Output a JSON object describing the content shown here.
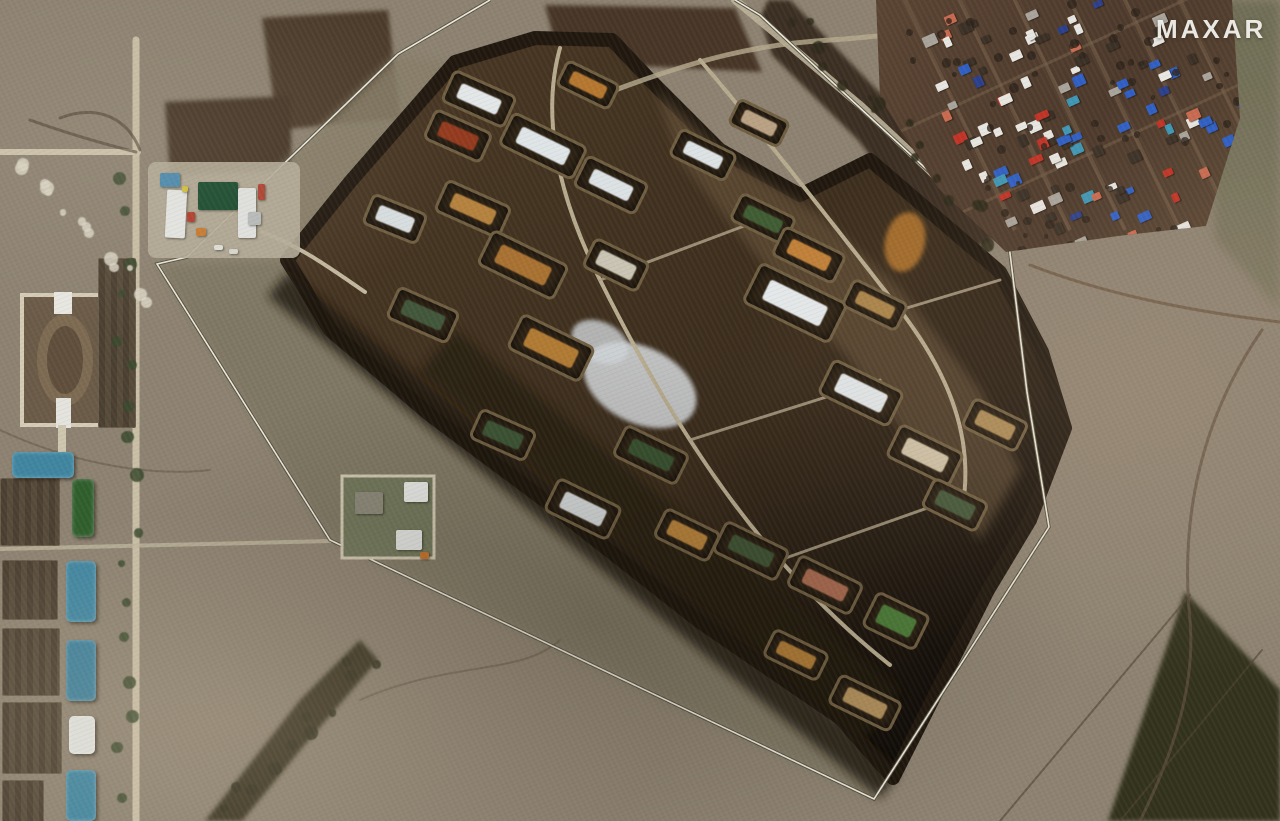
{
  "watermark": {
    "text": "MAXAR"
  },
  "palette": {
    "field": "#8d8271",
    "field_light": "#ac9f87",
    "field_green": "#7c765f",
    "buffer_green": "#7d7662",
    "compound_dark": "#3a2c1c",
    "compound_edge": "#20180f",
    "berm": "#6f5e41",
    "cell_floor": "#2e2315",
    "road_light": "#c9bfa6",
    "track_dark": "#5d4c3a",
    "fence_white": "#ece8dc",
    "debris_white": "#d6dadd",
    "village_ground": "#52402f",
    "teal_roof": "#3f85a0",
    "green_roof": "#2f5e2c"
  },
  "compound": {
    "revetments": [
      {
        "x": 476,
        "y": 96,
        "w": 64,
        "h": 30,
        "rot": 24,
        "content": "white-sheds",
        "color": "#e3e7e8"
      },
      {
        "x": 455,
        "y": 133,
        "w": 58,
        "h": 28,
        "rot": 24,
        "content": "red-scrap-pile",
        "color": "#93391d"
      },
      {
        "x": 540,
        "y": 143,
        "w": 78,
        "h": 32,
        "rot": 26,
        "content": "white-warehouse",
        "color": "#dfe5e7"
      },
      {
        "x": 470,
        "y": 206,
        "w": 66,
        "h": 30,
        "rot": 24,
        "content": "ochre-piles",
        "color": "#b5823e"
      },
      {
        "x": 608,
        "y": 182,
        "w": 64,
        "h": 30,
        "rot": 26,
        "content": "white-sheds",
        "color": "#dce2e4"
      },
      {
        "x": 392,
        "y": 216,
        "w": 54,
        "h": 28,
        "rot": 22,
        "content": "white-shed",
        "color": "#d8dee0"
      },
      {
        "x": 520,
        "y": 262,
        "w": 80,
        "h": 34,
        "rot": 26,
        "content": "tan-piles",
        "color": "#a87131"
      },
      {
        "x": 613,
        "y": 262,
        "w": 56,
        "h": 28,
        "rot": 26,
        "content": "mixed-debris",
        "color": "#c9c4b4"
      },
      {
        "x": 792,
        "y": 300,
        "w": 92,
        "h": 40,
        "rot": 26,
        "content": "white-warehouse",
        "color": "#e4e8ea"
      },
      {
        "x": 420,
        "y": 312,
        "w": 62,
        "h": 30,
        "rot": 24,
        "content": "green-hut",
        "color": "#41563a"
      },
      {
        "x": 548,
        "y": 345,
        "w": 76,
        "h": 34,
        "rot": 26,
        "content": "ochre-piles",
        "color": "#b07a33"
      },
      {
        "x": 760,
        "y": 216,
        "w": 56,
        "h": 26,
        "rot": 26,
        "content": "green-trees",
        "color": "#3f5c33"
      },
      {
        "x": 806,
        "y": 252,
        "w": 64,
        "h": 28,
        "rot": 26,
        "content": "orange-piles",
        "color": "#c08038"
      },
      {
        "x": 858,
        "y": 390,
        "w": 74,
        "h": 34,
        "rot": 26,
        "content": "white-sheds",
        "color": "#e0e5e7"
      },
      {
        "x": 922,
        "y": 452,
        "w": 66,
        "h": 32,
        "rot": 26,
        "content": "mixed-material",
        "color": "#cfc3a8"
      },
      {
        "x": 500,
        "y": 432,
        "w": 56,
        "h": 28,
        "rot": 24,
        "content": "green-hut",
        "color": "#3c5434"
      },
      {
        "x": 580,
        "y": 506,
        "w": 66,
        "h": 32,
        "rot": 26,
        "content": "white-debris",
        "color": "#d3d7d8"
      },
      {
        "x": 648,
        "y": 452,
        "w": 66,
        "h": 30,
        "rot": 26,
        "content": "green-sheds",
        "color": "#37502f"
      },
      {
        "x": 684,
        "y": 532,
        "w": 56,
        "h": 28,
        "rot": 26,
        "content": "ochre-pile",
        "color": "#b5813a"
      },
      {
        "x": 748,
        "y": 548,
        "w": 66,
        "h": 30,
        "rot": 26,
        "content": "green-trucks",
        "color": "#3e5233"
      },
      {
        "x": 822,
        "y": 582,
        "w": 66,
        "h": 30,
        "rot": 26,
        "content": "red-white-material",
        "color": "#a86a50"
      },
      {
        "x": 893,
        "y": 618,
        "w": 54,
        "h": 34,
        "rot": 26,
        "content": "green-roof-building",
        "color": "#4c7c39"
      },
      {
        "x": 793,
        "y": 652,
        "w": 56,
        "h": 26,
        "rot": 26,
        "content": "ochre-pile",
        "color": "#ad7a36"
      },
      {
        "x": 862,
        "y": 700,
        "w": 64,
        "h": 28,
        "rot": 26,
        "content": "tan-piles",
        "color": "#b08f5c"
      },
      {
        "x": 952,
        "y": 502,
        "w": 56,
        "h": 28,
        "rot": 26,
        "content": "green-vehicles",
        "color": "#44583a"
      },
      {
        "x": 992,
        "y": 422,
        "w": 56,
        "h": 28,
        "rot": 26,
        "content": "tan-piles",
        "color": "#ab8a56"
      },
      {
        "x": 872,
        "y": 302,
        "w": 56,
        "h": 26,
        "rot": 26,
        "content": "tan-piles",
        "color": "#a98349"
      },
      {
        "x": 700,
        "y": 152,
        "w": 58,
        "h": 26,
        "rot": 26,
        "content": "white-sheds",
        "color": "#dde2e4"
      },
      {
        "x": 585,
        "y": 82,
        "w": 54,
        "h": 24,
        "rot": 26,
        "content": "orange-piles",
        "color": "#b5772f"
      },
      {
        "x": 756,
        "y": 120,
        "w": 52,
        "h": 24,
        "rot": 26,
        "content": "mixed-material",
        "color": "#b9a183"
      }
    ]
  },
  "west_facility": {
    "buildings": [
      {
        "x": 12,
        "y": 452,
        "w": 62,
        "h": 26,
        "rot": 0,
        "color": "#3f85a0",
        "name": "teal-roof-warehouse"
      },
      {
        "x": 72,
        "y": 479,
        "w": 22,
        "h": 58,
        "rot": 0,
        "color": "#2f5e2c",
        "name": "green-roof-warehouse"
      },
      {
        "x": 66,
        "y": 561,
        "w": 30,
        "h": 61,
        "rot": 0,
        "color": "#3f85a0",
        "name": "teal-roof-warehouse"
      },
      {
        "x": 66,
        "y": 640,
        "w": 30,
        "h": 61,
        "rot": 0,
        "color": "#3d7f9a",
        "name": "teal-roof-warehouse"
      },
      {
        "x": 69,
        "y": 716,
        "w": 26,
        "h": 38,
        "rot": 0,
        "color": "#dfe2df",
        "name": "white-roof-warehouse"
      },
      {
        "x": 66,
        "y": 770,
        "w": 30,
        "h": 51,
        "rot": 0,
        "color": "#3f85a0",
        "name": "teal-roof-warehouse"
      }
    ],
    "garden_plots": [
      {
        "x": 2,
        "y": 560,
        "w": 54,
        "h": 58
      },
      {
        "x": 2,
        "y": 628,
        "w": 56,
        "h": 66
      },
      {
        "x": 2,
        "y": 702,
        "w": 58,
        "h": 70
      },
      {
        "x": 2,
        "y": 780,
        "w": 40,
        "h": 41
      },
      {
        "x": 0,
        "y": 478,
        "w": 58,
        "h": 66
      },
      {
        "x": 98,
        "y": 258,
        "w": 36,
        "h": 168
      }
    ]
  },
  "north_facility": {
    "items": [
      {
        "x": 160,
        "y": 173,
        "w": 20,
        "h": 14,
        "rot": 0,
        "color": "#4a8ab0",
        "name": "blue-roof-building"
      },
      {
        "x": 166,
        "y": 190,
        "w": 20,
        "h": 48,
        "rot": 3,
        "color": "#e6e8e6",
        "name": "white-tent-building"
      },
      {
        "x": 198,
        "y": 182,
        "w": 40,
        "h": 28,
        "rot": 0,
        "color": "#174a2e",
        "name": "reservoir-pond"
      },
      {
        "x": 238,
        "y": 188,
        "w": 18,
        "h": 50,
        "rot": 0,
        "color": "#e2e4e2",
        "name": "white-building"
      },
      {
        "x": 187,
        "y": 212,
        "w": 8,
        "h": 10,
        "rot": 0,
        "color": "#b33b2a",
        "name": "red-container"
      },
      {
        "x": 196,
        "y": 228,
        "w": 10,
        "h": 8,
        "rot": 0,
        "color": "#c97a2e",
        "name": "orange-container"
      },
      {
        "x": 182,
        "y": 186,
        "w": 6,
        "h": 6,
        "rot": 0,
        "color": "#d4c23a",
        "name": "yellow-object"
      },
      {
        "x": 258,
        "y": 184,
        "w": 7,
        "h": 16,
        "rot": 0,
        "color": "#b04030",
        "name": "red-tower"
      },
      {
        "x": 248,
        "y": 212,
        "w": 13,
        "h": 13,
        "rot": 0,
        "color": "#b8bcbc",
        "name": "storage-tank"
      },
      {
        "x": 214,
        "y": 245,
        "w": 9,
        "h": 5,
        "rot": 0,
        "color": "#e0e0da",
        "name": "vehicle"
      },
      {
        "x": 229,
        "y": 249,
        "w": 9,
        "h": 5,
        "rot": 0,
        "color": "#d8d8d2",
        "name": "vehicle"
      }
    ]
  },
  "walled_compound": {
    "items": [
      {
        "x": 404,
        "y": 482,
        "w": 24,
        "h": 20,
        "rot": 0,
        "color": "#e4e6e3",
        "name": "white-building"
      },
      {
        "x": 396,
        "y": 530,
        "w": 26,
        "h": 20,
        "rot": 0,
        "color": "#dfe1de",
        "name": "white-building"
      },
      {
        "x": 355,
        "y": 492,
        "w": 28,
        "h": 22,
        "rot": 0,
        "color": "#8a8778",
        "name": "gray-shed"
      },
      {
        "x": 420,
        "y": 552,
        "w": 9,
        "h": 7,
        "rot": 0,
        "color": "#c2702a",
        "name": "orange-object"
      }
    ]
  },
  "village": {
    "house_palette": [
      "#e8e6e1",
      "#3a3026",
      "#2f5fc4",
      "#c03326",
      "#3f96b4",
      "#2b3f8c",
      "#a8a49c",
      "#c86a50"
    ],
    "house_weights": [
      28,
      20,
      12,
      10,
      8,
      6,
      10,
      6
    ],
    "house_count": 130,
    "tree_count": 70
  },
  "scatter": {
    "road_trees": {
      "x0": 124,
      "y0": 170,
      "x1": 124,
      "y1": 790,
      "count": 17,
      "color": "#3a4a2e"
    },
    "ravine_trees": {
      "x0": 790,
      "y0": 15,
      "x1": 990,
      "y1": 225,
      "count": 16,
      "color": "#2e2a1a"
    },
    "band_trees": {
      "x0": 222,
      "y0": 805,
      "x1": 365,
      "y1": 650,
      "count": 11,
      "color": "#32301f"
    },
    "white_dots": {
      "x0": 15,
      "y0": 150,
      "x1": 140,
      "y1": 295,
      "count": 14,
      "color": "#dcd6c6"
    }
  }
}
